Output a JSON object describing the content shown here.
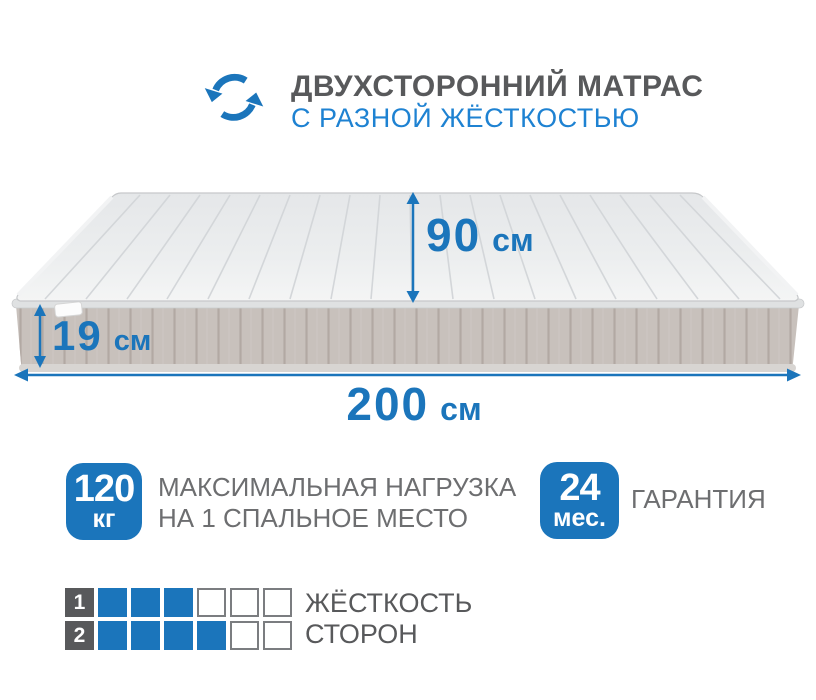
{
  "colors": {
    "accent_blue": "#1b75bb",
    "subtitle_blue": "#1e82d2",
    "text_dark_gray": "#58595b",
    "text_gray": "#6d6e70",
    "mattress_top": "#eceeef",
    "mattress_side": "#c8c1bc"
  },
  "header": {
    "icon": "two-sided-rotate-icon",
    "title": "ДВУХСТОРОННИЙ МАТРАС",
    "subtitle": "С РАЗНОЙ ЖЁСТКОСТЬЮ"
  },
  "dimensions": {
    "depth": {
      "value": "90",
      "unit": "см"
    },
    "thickness": {
      "value": "19",
      "unit": "см"
    },
    "width": {
      "value": "200",
      "unit": "см"
    }
  },
  "features": {
    "max_load": {
      "badge_value": "120",
      "badge_unit": "кг",
      "line1": "МАКСИМАЛЬНАЯ НАГРУЗКА",
      "line2": "НА 1 СПАЛЬНОЕ МЕСТО"
    },
    "warranty": {
      "badge_value": "24",
      "badge_unit": "мес.",
      "label": "ГАРАНТИЯ"
    }
  },
  "firmness": {
    "label_line1": "ЖЁСТКОСТЬ",
    "label_line2": "СТОРОН",
    "scale_max": 6,
    "rows": [
      {
        "side": "1",
        "filled": 3
      },
      {
        "side": "2",
        "filled": 4
      }
    ]
  }
}
